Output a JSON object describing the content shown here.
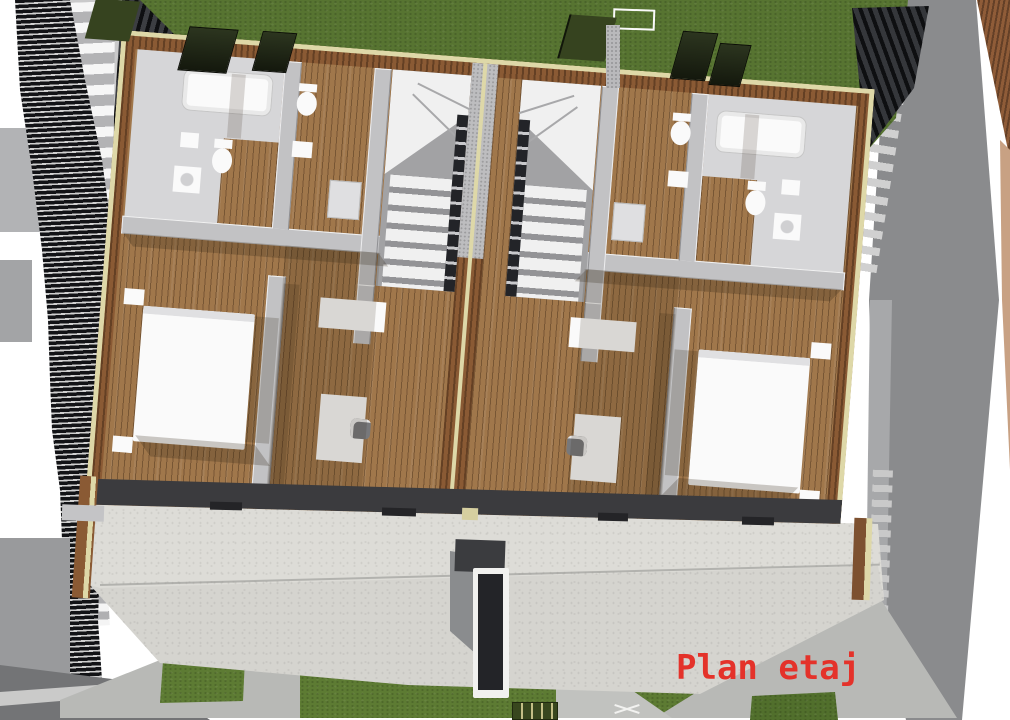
{
  "annotation": {
    "label": "Plan etaj",
    "color": "#e4322a"
  },
  "palette": {
    "grass_top": "#577431",
    "grass_patch": "#5d7b33",
    "grass_dark": "#2e3a18",
    "wood_wall": "#8a5a34",
    "wall_plate": "#ded8a8",
    "wood_floor": "#a0774b",
    "interior_wall": "#c2c2c4",
    "bathroom_floor": "#d6d6d8",
    "stair_tread": "#f0f0f0",
    "stair_dark": "#232428",
    "slab": "#dddcd7",
    "ground": "#8a8b8d",
    "path": "#b8b9b6",
    "hedge": "#121316",
    "roof_dark": "#0e0f11",
    "band": "#3b3b3e",
    "fixture": "#fafafa",
    "canopy": "#36431f",
    "label_red": "#e4322a"
  }
}
